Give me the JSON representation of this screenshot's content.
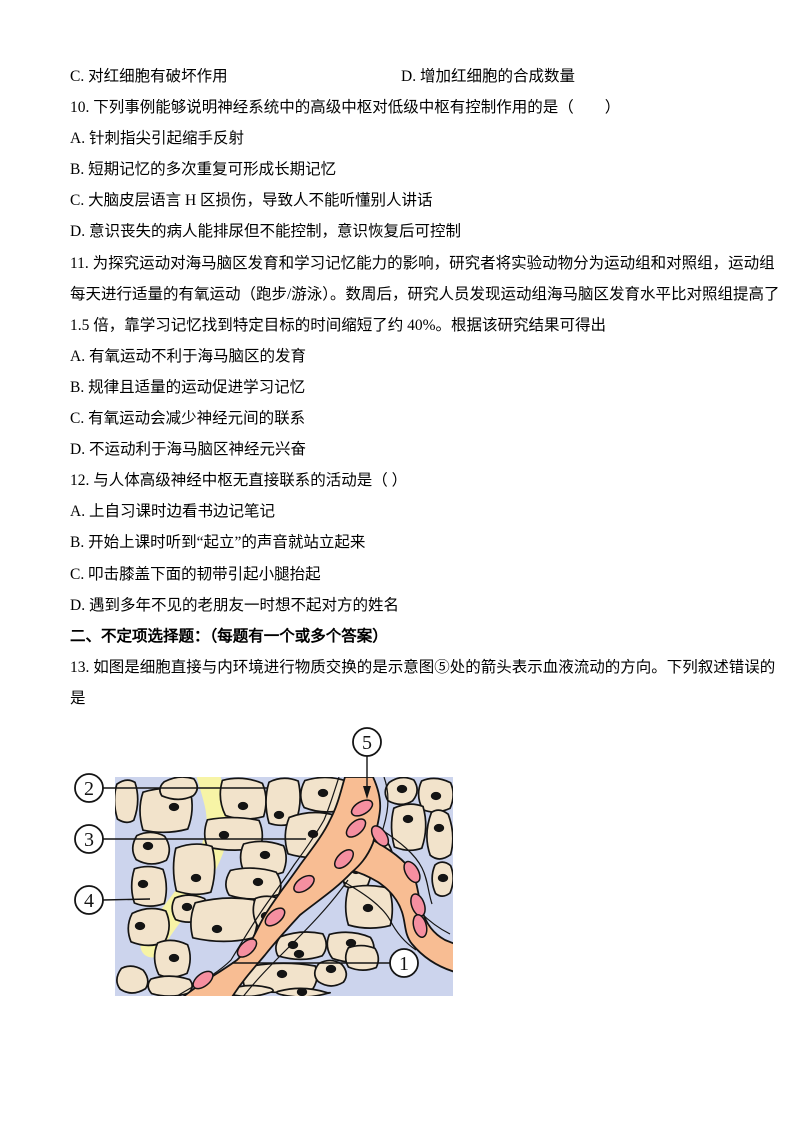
{
  "document": {
    "lines": [
      {
        "left": "C. 对红细胞有破坏作用",
        "right": "D. 增加红细胞的合成数量"
      },
      {
        "text": "10. 下列事例能够说明神经系统中的高级中枢对低级中枢有控制作用的是（　　）"
      },
      {
        "text": "A. 针刺指尖引起缩手反射"
      },
      {
        "text": "B. 短期记忆的多次重复可形成长期记忆"
      },
      {
        "text": "C. 大脑皮层语言 H 区损伤，导致人不能听懂别人讲话"
      },
      {
        "text": "D. 意识丧失的病人能排尿但不能控制，意识恢复后可控制"
      },
      {
        "text": "11. 为探究运动对海马脑区发育和学习记忆能力的影响，研究者将实验动物分为运动组和对照组，运动组"
      },
      {
        "text": "每天进行适量的有氧运动（跑步/游泳）。数周后，研究人员发现运动组海马脑区发育水平比对照组提高了"
      },
      {
        "text": "1.5 倍，靠学习记忆找到特定目标的时间缩短了约 40%。根据该研究结果可得出"
      },
      {
        "text": "A. 有氧运动不利于海马脑区的发育"
      },
      {
        "text": "B. 规律且适量的运动促进学习记忆"
      },
      {
        "text": "C. 有氧运动会减少神经元间的联系"
      },
      {
        "text": "D. 不运动利于海马脑区神经元兴奋"
      },
      {
        "text": "12. 与人体高级神经中枢无直接联系的活动是（ ）"
      },
      {
        "text": "A. 上自习课时边看书边记笔记"
      },
      {
        "text": "B. 开始上课时听到“起立”的声音就站立起来"
      },
      {
        "text": "C. 叩击膝盖下面的韧带引起小腿抬起"
      },
      {
        "text": "D. 遇到多年不见的老朋友一时想不起对方的姓名"
      },
      {
        "text": "二、不定项选择题：（每题有一个或多个答案）",
        "bold": true
      },
      {
        "text": "13. 如图是细胞直接与内环境进行物质交换的是示意图⑤处的箭头表示血液流动的方向。下列叙述错误的"
      },
      {
        "text": "是"
      }
    ]
  },
  "figure": {
    "labels": {
      "n1": "1",
      "n2": "2",
      "n3": "3",
      "n4": "4",
      "n5": "5"
    },
    "legend": {
      "n1": "blood-vessel-interior",
      "n2": "intercellular-fluid-region",
      "n3": "tissue-cell",
      "n4": "lymph-vessel",
      "n5": "blood-flow-direction-arrow"
    },
    "colors": {
      "diagram_bg": "#ccd4ed",
      "cell_fill": "#f2e3cb",
      "vessel_fill": "#f8bd93",
      "rbc_fill": "#f58fa0",
      "lymph_fill": "#f7f4a6",
      "line_color": "#141414"
    }
  }
}
